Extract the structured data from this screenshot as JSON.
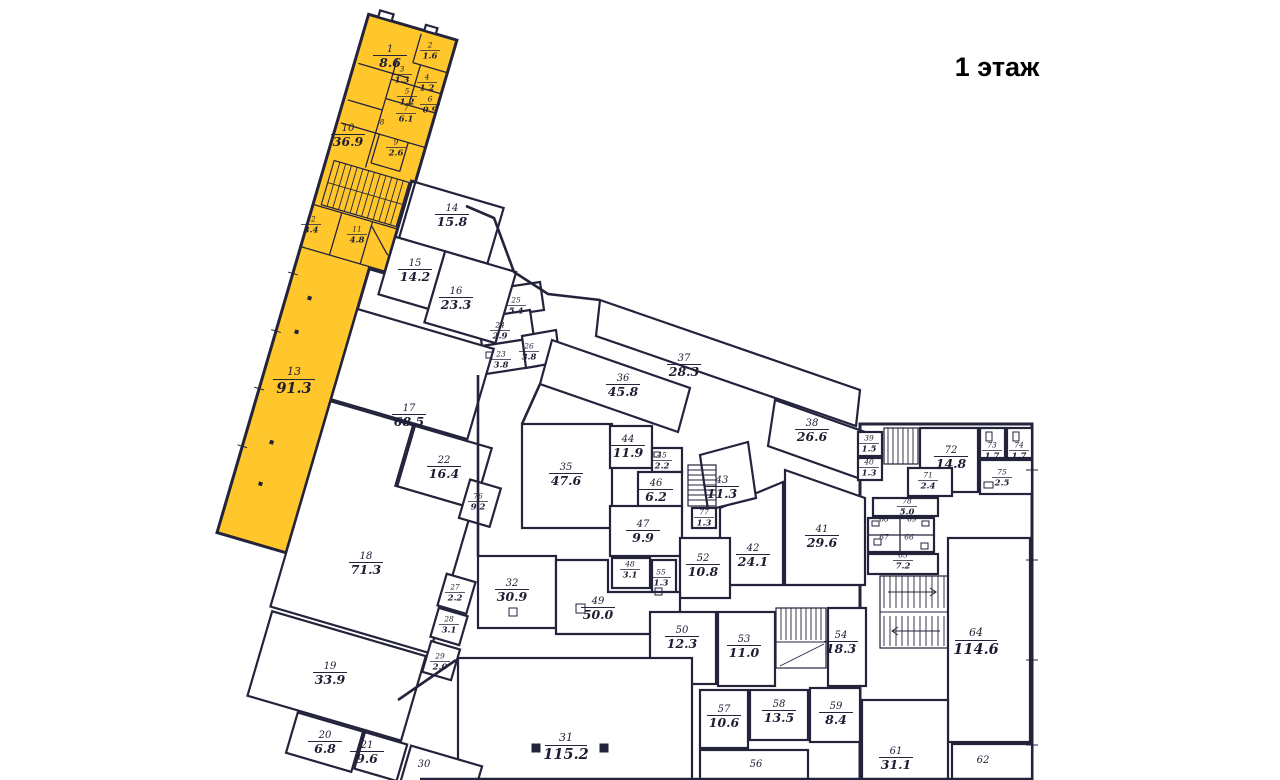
{
  "title": "1 этаж",
  "colors": {
    "highlight": "#FFC72C",
    "wall": "#23233C"
  },
  "rooms": [
    {
      "n": "1",
      "a": "8.6",
      "x": 390,
      "y": 55,
      "s": "md",
      "hl": true
    },
    {
      "n": "2",
      "a": "1.6",
      "x": 430,
      "y": 50,
      "s": "sm",
      "hl": true
    },
    {
      "n": "3",
      "a": "1.3",
      "x": 402,
      "y": 74,
      "s": "sm",
      "hl": true
    },
    {
      "n": "4",
      "a": "1.2",
      "x": 427,
      "y": 82,
      "s": "sm",
      "hl": true
    },
    {
      "n": "5",
      "a": "1.2",
      "x": 407,
      "y": 96,
      "s": "sm",
      "hl": true
    },
    {
      "n": "6",
      "a": "0.9",
      "x": 430,
      "y": 104,
      "s": "sm",
      "hl": true
    },
    {
      "n": "7",
      "a": "6.1",
      "x": 406,
      "y": 113,
      "s": "sm",
      "hl": true
    },
    {
      "n": "8",
      "a": "",
      "x": 382,
      "y": 127,
      "s": "sm",
      "hl": true
    },
    {
      "n": "9",
      "a": "2.6",
      "x": 396,
      "y": 147,
      "s": "sm",
      "hl": true
    },
    {
      "n": "10",
      "a": "36.9",
      "x": 348,
      "y": 134,
      "s": "md",
      "hl": true
    },
    {
      "n": "11",
      "a": "4.8",
      "x": 357,
      "y": 234,
      "s": "sm",
      "hl": true
    },
    {
      "n": "12",
      "a": "3.4",
      "x": 311,
      "y": 224,
      "s": "sm",
      "hl": true
    },
    {
      "n": "13",
      "a": "91.3",
      "x": 294,
      "y": 379,
      "s": "lg",
      "hl": true
    },
    {
      "n": "14",
      "a": "15.8",
      "x": 452,
      "y": 214,
      "s": "md",
      "hl": false
    },
    {
      "n": "15",
      "a": "14.2",
      "x": 415,
      "y": 269,
      "s": "md",
      "hl": false
    },
    {
      "n": "16",
      "a": "23.3",
      "x": 456,
      "y": 297,
      "s": "md",
      "hl": false
    },
    {
      "n": "17",
      "a": "68.5",
      "x": 409,
      "y": 414,
      "s": "md",
      "hl": false
    },
    {
      "n": "18",
      "a": "71.3",
      "x": 366,
      "y": 562,
      "s": "md",
      "hl": false
    },
    {
      "n": "19",
      "a": "33.9",
      "x": 330,
      "y": 672,
      "s": "md",
      "hl": false
    },
    {
      "n": "20",
      "a": "6.8",
      "x": 325,
      "y": 741,
      "s": "md",
      "hl": false
    },
    {
      "n": "21",
      "a": "9.6",
      "x": 367,
      "y": 751,
      "s": "md",
      "hl": false
    },
    {
      "n": "22",
      "a": "16.4",
      "x": 444,
      "y": 466,
      "s": "md",
      "hl": false
    },
    {
      "n": "23",
      "a": "3.8",
      "x": 501,
      "y": 359,
      "s": "sm",
      "hl": false
    },
    {
      "n": "24",
      "a": "2.9",
      "x": 500,
      "y": 330,
      "s": "sm",
      "hl": false
    },
    {
      "n": "25",
      "a": "5.4",
      "x": 516,
      "y": 305,
      "s": "sm",
      "hl": false
    },
    {
      "n": "26",
      "a": "3.8",
      "x": 529,
      "y": 351,
      "s": "sm",
      "hl": false
    },
    {
      "n": "27",
      "a": "2.2",
      "x": 455,
      "y": 592,
      "s": "sm",
      "hl": false
    },
    {
      "n": "28",
      "a": "3.1",
      "x": 449,
      "y": 624,
      "s": "sm",
      "hl": false
    },
    {
      "n": "29",
      "a": "2.0",
      "x": 440,
      "y": 661,
      "s": "sm",
      "hl": false
    },
    {
      "n": "30",
      "a": "",
      "x": 424,
      "y": 770,
      "s": "md",
      "hl": false
    },
    {
      "n": "31",
      "a": "115.2",
      "x": 566,
      "y": 745,
      "s": "lg",
      "hl": false
    },
    {
      "n": "32",
      "a": "30.9",
      "x": 512,
      "y": 589,
      "s": "md",
      "hl": false
    },
    {
      "n": "35",
      "a": "47.6",
      "x": 566,
      "y": 473,
      "s": "md",
      "hl": false
    },
    {
      "n": "36",
      "a": "45.8",
      "x": 623,
      "y": 384,
      "s": "md",
      "hl": false
    },
    {
      "n": "37",
      "a": "28.3",
      "x": 684,
      "y": 364,
      "s": "md",
      "hl": false
    },
    {
      "n": "38",
      "a": "26.6",
      "x": 812,
      "y": 429,
      "s": "md",
      "hl": false
    },
    {
      "n": "39",
      "a": "1.5",
      "x": 869,
      "y": 443,
      "s": "sm",
      "hl": false
    },
    {
      "n": "40",
      "a": "1.3",
      "x": 869,
      "y": 467,
      "s": "sm",
      "hl": false
    },
    {
      "n": "41",
      "a": "29.6",
      "x": 822,
      "y": 535,
      "s": "md",
      "hl": false
    },
    {
      "n": "42",
      "a": "24.1",
      "x": 753,
      "y": 554,
      "s": "md",
      "hl": false
    },
    {
      "n": "43",
      "a": "11.3",
      "x": 722,
      "y": 486,
      "s": "md",
      "hl": false
    },
    {
      "n": "44",
      "a": "11.9",
      "x": 628,
      "y": 445,
      "s": "md",
      "hl": false
    },
    {
      "n": "45",
      "a": "2.2",
      "x": 662,
      "y": 460,
      "s": "sm",
      "hl": false
    },
    {
      "n": "46",
      "a": "6.2",
      "x": 656,
      "y": 489,
      "s": "md",
      "hl": false
    },
    {
      "n": "47",
      "a": "9.9",
      "x": 643,
      "y": 530,
      "s": "md",
      "hl": false
    },
    {
      "n": "48",
      "a": "3.1",
      "x": 630,
      "y": 569,
      "s": "sm",
      "hl": false
    },
    {
      "n": "49",
      "a": "50.0",
      "x": 598,
      "y": 607,
      "s": "md",
      "hl": false
    },
    {
      "n": "50",
      "a": "12.3",
      "x": 682,
      "y": 636,
      "s": "md",
      "hl": false
    },
    {
      "n": "52",
      "a": "10.8",
      "x": 703,
      "y": 564,
      "s": "md",
      "hl": false
    },
    {
      "n": "53",
      "a": "11.0",
      "x": 744,
      "y": 645,
      "s": "md",
      "hl": false
    },
    {
      "n": "54",
      "a": "18.3",
      "x": 841,
      "y": 641,
      "s": "md",
      "hl": false
    },
    {
      "n": "55",
      "a": "1.3",
      "x": 661,
      "y": 577,
      "s": "sm",
      "hl": false
    },
    {
      "n": "56",
      "a": "",
      "x": 756,
      "y": 770,
      "s": "md",
      "hl": false
    },
    {
      "n": "57",
      "a": "10.6",
      "x": 724,
      "y": 715,
      "s": "md",
      "hl": false
    },
    {
      "n": "58",
      "a": "13.5",
      "x": 779,
      "y": 710,
      "s": "md",
      "hl": false
    },
    {
      "n": "59",
      "a": "8.4",
      "x": 836,
      "y": 712,
      "s": "md",
      "hl": false
    },
    {
      "n": "61",
      "a": "31.1",
      "x": 896,
      "y": 757,
      "s": "md",
      "hl": false
    },
    {
      "n": "62",
      "a": "",
      "x": 983,
      "y": 766,
      "s": "md",
      "hl": false
    },
    {
      "n": "64",
      "a": "114.6",
      "x": 976,
      "y": 640,
      "s": "lg",
      "hl": false
    },
    {
      "n": "65",
      "a": "7.2",
      "x": 903,
      "y": 560,
      "s": "sm",
      "hl": false
    },
    {
      "n": "66",
      "a": "",
      "x": 909,
      "y": 542,
      "s": "sm",
      "hl": false
    },
    {
      "n": "67",
      "a": "",
      "x": 884,
      "y": 542,
      "s": "sm",
      "hl": false
    },
    {
      "n": "68",
      "a": "",
      "x": 884,
      "y": 524,
      "s": "sm",
      "hl": false
    },
    {
      "n": "69",
      "a": "",
      "x": 912,
      "y": 524,
      "s": "sm",
      "hl": false
    },
    {
      "n": "71",
      "a": "2.4",
      "x": 928,
      "y": 480,
      "s": "sm",
      "hl": false
    },
    {
      "n": "72",
      "a": "14.8",
      "x": 951,
      "y": 456,
      "s": "md",
      "hl": false
    },
    {
      "n": "73",
      "a": "1.7",
      "x": 992,
      "y": 450,
      "s": "sm",
      "hl": false
    },
    {
      "n": "74",
      "a": "1.7",
      "x": 1019,
      "y": 450,
      "s": "sm",
      "hl": false
    },
    {
      "n": "75",
      "a": "2.5",
      "x": 1002,
      "y": 477,
      "s": "sm",
      "hl": false
    },
    {
      "n": "76",
      "a": "9.2",
      "x": 478,
      "y": 501,
      "s": "sm",
      "hl": false
    },
    {
      "n": "77",
      "a": "1.3",
      "x": 704,
      "y": 517,
      "s": "sm",
      "hl": false
    },
    {
      "n": "78",
      "a": "5.0",
      "x": 907,
      "y": 506,
      "s": "sm",
      "hl": false
    }
  ]
}
